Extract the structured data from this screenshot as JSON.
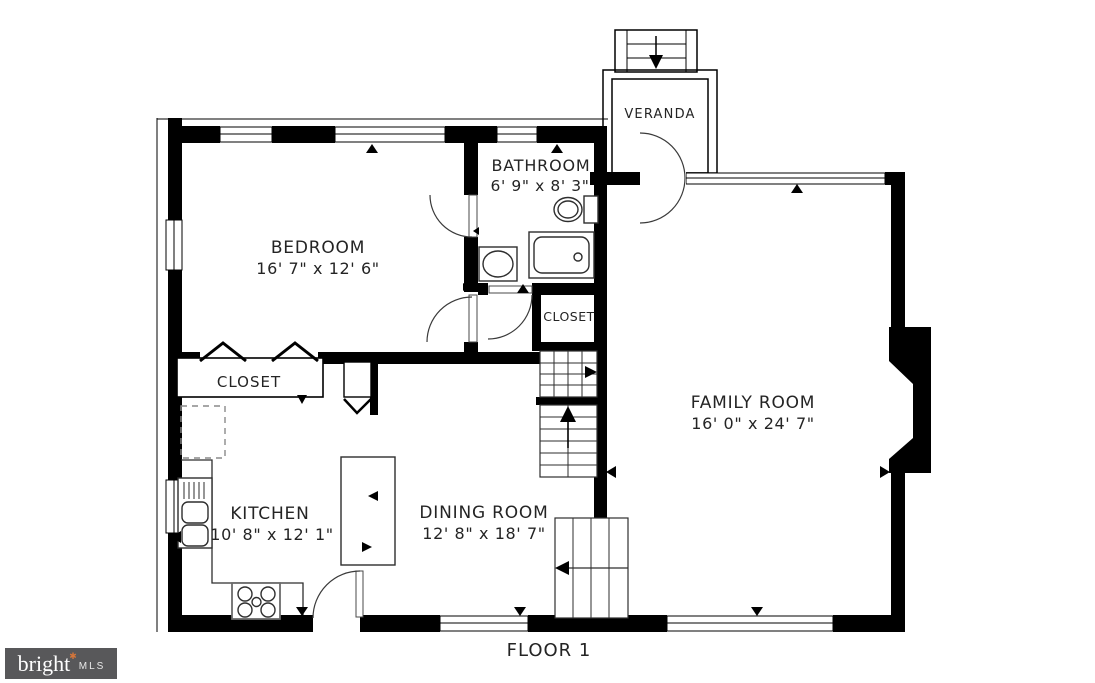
{
  "floor": {
    "label": "FLOOR 1"
  },
  "brand": {
    "word": "bright",
    "star": "✱",
    "suffix": "MLS"
  },
  "colors": {
    "wall": "#000000",
    "line": "#2e2e2e",
    "text": "#242424",
    "background": "#ffffff",
    "logo_background": "#58585a",
    "logo_star": "#d4763b"
  },
  "rooms": {
    "bedroom": {
      "label": "BEDROOM",
      "dims": "16' 7\" x 12' 6\""
    },
    "bathroom": {
      "label": "BATHROOM",
      "dims": "6' 9\" x 8' 3\""
    },
    "veranda": {
      "label": "VERANDA"
    },
    "family_room": {
      "label": "FAMILY ROOM",
      "dims": "16' 0\" x 24' 7\""
    },
    "kitchen": {
      "label": "KITCHEN",
      "dims": "10' 8\" x 12' 1\""
    },
    "dining_room": {
      "label": "DINING ROOM",
      "dims": "12' 8\" x 18' 7\""
    },
    "closet_bedroom": {
      "label": "CLOSET"
    },
    "closet_hall": {
      "label": "CLOSET"
    }
  }
}
